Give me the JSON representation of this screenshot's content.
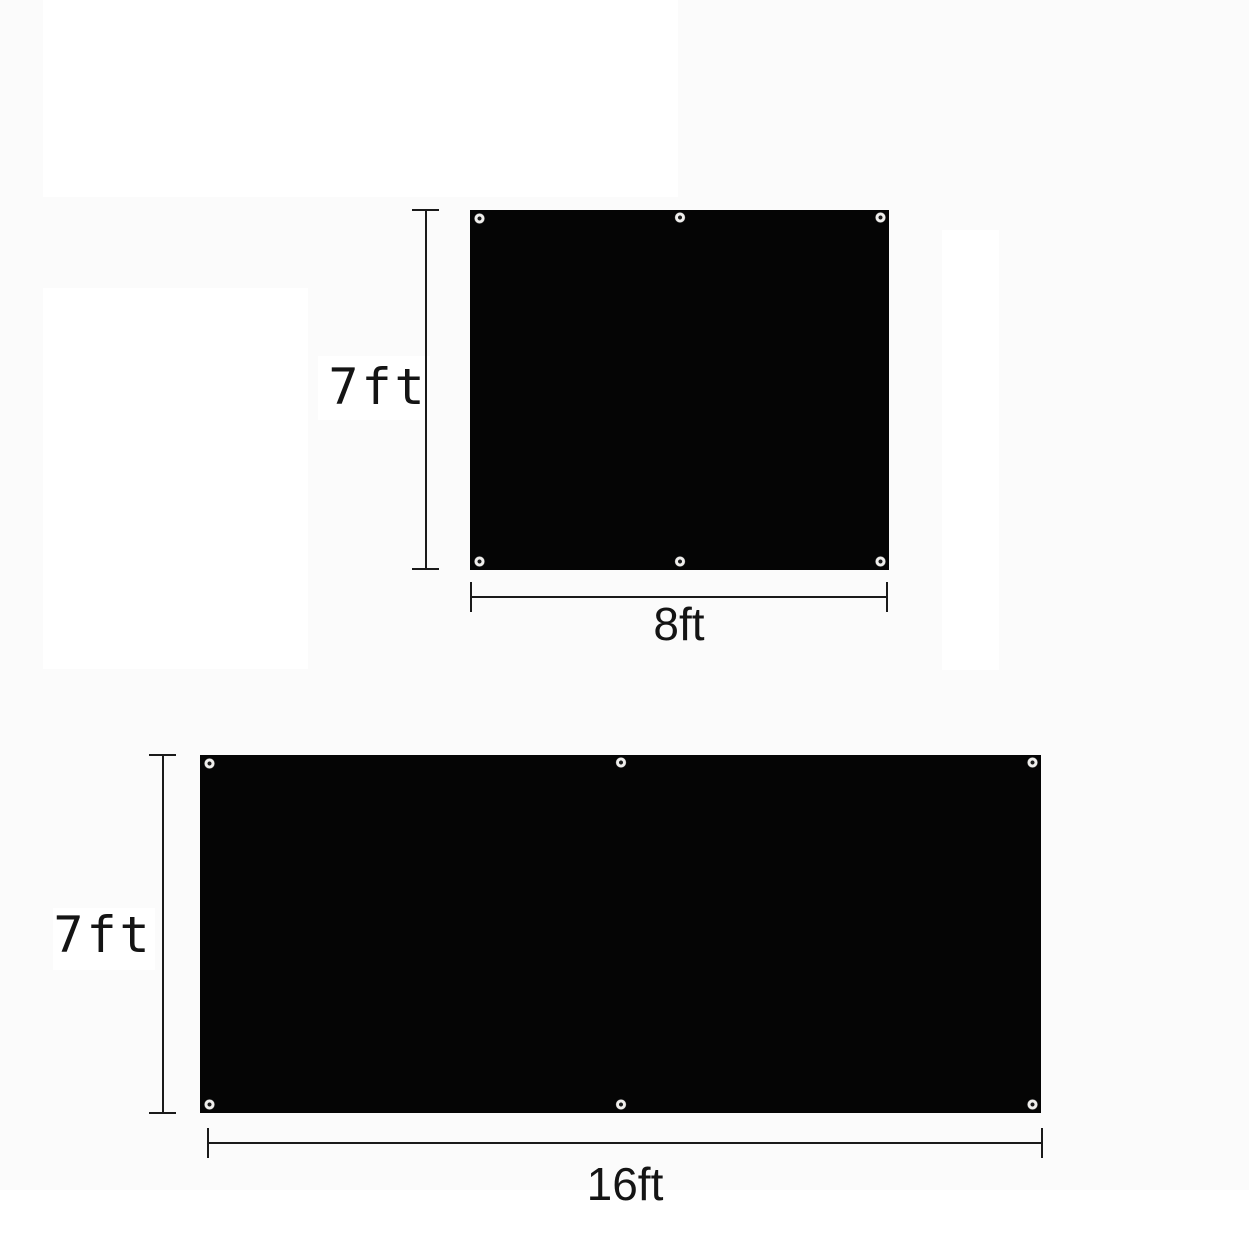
{
  "colors": {
    "tarp": "#050505",
    "dimension_line": "#1a1a1a",
    "label_text": "#141414",
    "background": "#fbfbfb",
    "grommet_ring": "#efeeec"
  },
  "figures": [
    {
      "name": "tarp-7ft-by-8ft",
      "height_label": "7ft",
      "width_label": "8ft",
      "grommets": [
        "top-left",
        "top-center",
        "top-right",
        "bottom-left",
        "bottom-center",
        "bottom-right"
      ]
    },
    {
      "name": "tarp-7ft-by-16ft",
      "height_label": "7ft",
      "width_label": "16ft",
      "grommets": [
        "top-left",
        "top-center",
        "top-right",
        "bottom-left",
        "bottom-center",
        "bottom-right"
      ]
    }
  ]
}
